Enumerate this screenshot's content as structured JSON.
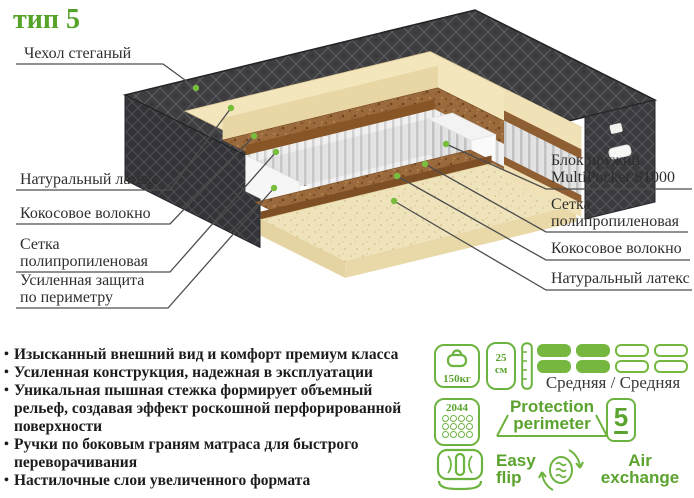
{
  "title": "тип 5",
  "labels": {
    "cover": {
      "lines": [
        "Чехол стеганый"
      ]
    },
    "latex_left": {
      "lines": [
        "Натуральный латекс"
      ]
    },
    "coconut_left": {
      "lines": [
        "Кокосовое волокно"
      ]
    },
    "mesh_left": {
      "lines": [
        "Сетка",
        "полипропиленовая"
      ]
    },
    "perimeter_left": {
      "lines": [
        "Усиленная защита",
        "по периметру"
      ]
    },
    "springs_right": {
      "lines": [
        "Блок пружин",
        "MultiPocket S1000"
      ]
    },
    "mesh_right": {
      "lines": [
        "Сетка",
        "полипропиленовая"
      ]
    },
    "coconut_right": {
      "lines": [
        "Кокосовое волокно"
      ]
    },
    "latex_right": {
      "lines": [
        "Натуральный латекс"
      ]
    }
  },
  "features": {
    "items": [
      "Изысканный внешний вид и комфорт премиум класса",
      "Усиленная конструкция, надежная в эксплуатации",
      "Уникальная пышная стежка формирует объемный рельеф, создавая эффект роскошной перфорированной поверхности",
      "Ручки по боковым граням матраса для быстрого переворачивания",
      "Настилочные слои увеличенного формата"
    ]
  },
  "badges": {
    "max_weight": {
      "value": "150кг"
    },
    "height": {
      "value": "25",
      "unit": "см"
    },
    "firmness": {
      "label": "Средняя / Средняя",
      "filled_segments": 2,
      "total_segments": 4
    },
    "spring_count": {
      "value": "2044"
    },
    "protection": {
      "line1": "Protection",
      "line2": "perimeter"
    },
    "warranty_years": {
      "value": "5"
    },
    "easy_flip": {
      "line1": "Easy",
      "line2": "flip"
    },
    "air_exchange": {
      "line1": "Air",
      "line2": "exchange"
    }
  },
  "colors": {
    "accent_green": "#6db33f",
    "title_green": "#56a32a",
    "label_text": "#2e2e2e"
  }
}
